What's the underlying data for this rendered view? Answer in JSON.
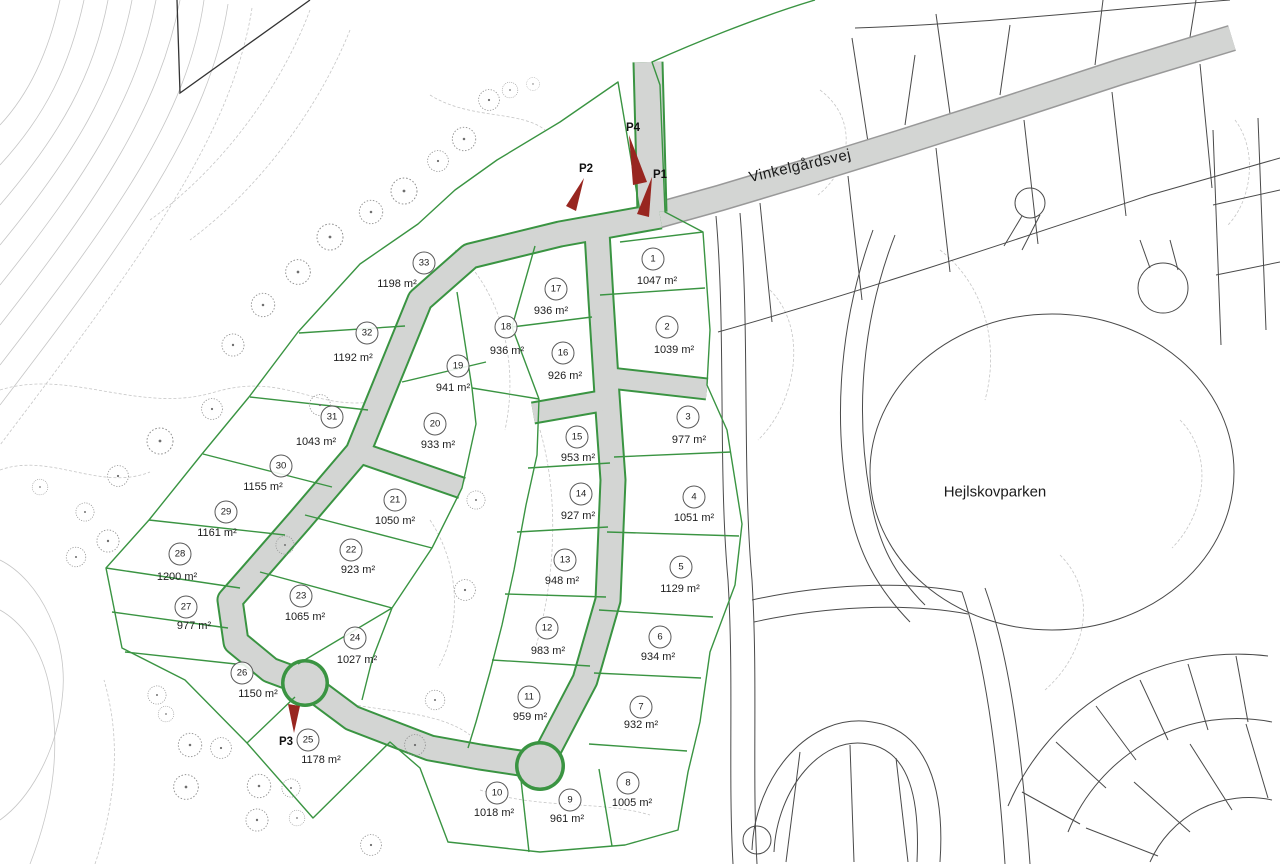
{
  "map": {
    "road_label": "Vinkelgårdsvej",
    "park_label": "Hejlskovparken"
  },
  "lots": [
    {
      "number": "1",
      "area": "1047 m²",
      "x": 653,
      "y": 259,
      "ax": 657,
      "ay": 281
    },
    {
      "number": "2",
      "area": "1039 m²",
      "x": 667,
      "y": 327,
      "ax": 674,
      "ay": 350
    },
    {
      "number": "3",
      "area": "977 m²",
      "x": 688,
      "y": 417,
      "ax": 689,
      "ay": 440
    },
    {
      "number": "4",
      "area": "1051 m²",
      "x": 694,
      "y": 497,
      "ax": 694,
      "ay": 518
    },
    {
      "number": "5",
      "area": "1129 m²",
      "x": 681,
      "y": 567,
      "ax": 680,
      "ay": 589
    },
    {
      "number": "6",
      "area": "934 m²",
      "x": 660,
      "y": 637,
      "ax": 658,
      "ay": 657
    },
    {
      "number": "7",
      "area": "932 m²",
      "x": 641,
      "y": 707,
      "ax": 641,
      "ay": 725
    },
    {
      "number": "8",
      "area": "1005 m²",
      "x": 628,
      "y": 783,
      "ax": 632,
      "ay": 803
    },
    {
      "number": "9",
      "area": "961 m²",
      "x": 570,
      "y": 800,
      "ax": 567,
      "ay": 819
    },
    {
      "number": "10",
      "area": "1018 m²",
      "x": 497,
      "y": 793,
      "ax": 494,
      "ay": 813
    },
    {
      "number": "11",
      "area": "959 m²",
      "x": 529,
      "y": 697,
      "ax": 530,
      "ay": 717
    },
    {
      "number": "12",
      "area": "983 m²",
      "x": 547,
      "y": 628,
      "ax": 548,
      "ay": 651
    },
    {
      "number": "13",
      "area": "948 m²",
      "x": 565,
      "y": 560,
      "ax": 562,
      "ay": 581
    },
    {
      "number": "14",
      "area": "927 m²",
      "x": 581,
      "y": 494,
      "ax": 578,
      "ay": 516
    },
    {
      "number": "15",
      "area": "953 m²",
      "x": 577,
      "y": 437,
      "ax": 578,
      "ay": 458
    },
    {
      "number": "16",
      "area": "926 m²",
      "x": 563,
      "y": 353,
      "ax": 565,
      "ay": 376
    },
    {
      "number": "17",
      "area": "936 m²",
      "x": 556,
      "y": 289,
      "ax": 551,
      "ay": 311
    },
    {
      "number": "18",
      "area": "936 m²",
      "x": 506,
      "y": 327,
      "ax": 507,
      "ay": 351
    },
    {
      "number": "19",
      "area": "941 m²",
      "x": 458,
      "y": 366,
      "ax": 453,
      "ay": 388
    },
    {
      "number": "20",
      "area": "933 m²",
      "x": 435,
      "y": 424,
      "ax": 438,
      "ay": 445
    },
    {
      "number": "21",
      "area": "1050 m²",
      "x": 395,
      "y": 500,
      "ax": 395,
      "ay": 521
    },
    {
      "number": "22",
      "area": "923 m²",
      "x": 351,
      "y": 550,
      "ax": 358,
      "ay": 570
    },
    {
      "number": "23",
      "area": "1065 m²",
      "x": 301,
      "y": 596,
      "ax": 305,
      "ay": 617
    },
    {
      "number": "24",
      "area": "1027 m²",
      "x": 355,
      "y": 638,
      "ax": 357,
      "ay": 660
    },
    {
      "number": "25",
      "area": "1178 m²",
      "x": 308,
      "y": 740,
      "ax": 321,
      "ay": 760
    },
    {
      "number": "26",
      "area": "1150 m²",
      "x": 242,
      "y": 673,
      "ax": 258,
      "ay": 694
    },
    {
      "number": "27",
      "area": "977 m²",
      "x": 186,
      "y": 607,
      "ax": 194,
      "ay": 626
    },
    {
      "number": "28",
      "area": "1200 m²",
      "x": 180,
      "y": 554,
      "ax": 177,
      "ay": 577
    },
    {
      "number": "29",
      "area": "1161 m²",
      "x": 226,
      "y": 512,
      "ax": 217,
      "ay": 533
    },
    {
      "number": "30",
      "area": "1155 m²",
      "x": 281,
      "y": 466,
      "ax": 263,
      "ay": 487
    },
    {
      "number": "31",
      "area": "1043 m²",
      "x": 332,
      "y": 417,
      "ax": 316,
      "ay": 442
    },
    {
      "number": "32",
      "area": "1192 m²",
      "x": 367,
      "y": 333,
      "ax": 353,
      "ay": 358
    },
    {
      "number": "33",
      "area": "1198 m²",
      "x": 424,
      "y": 263,
      "ax": 397,
      "ay": 284
    }
  ],
  "flags": [
    {
      "label": "P1",
      "x": 660,
      "y": 175
    },
    {
      "label": "P2",
      "x": 586,
      "y": 169
    },
    {
      "label": "P3",
      "x": 286,
      "y": 742
    },
    {
      "label": "P4",
      "x": 633,
      "y": 128
    }
  ],
  "colors": {
    "parcel_line": "#3a9442",
    "road_fill": "#d3d5d3",
    "road_edge": "#999999",
    "existing_line": "#4a4a4a",
    "contour": "#c6c6c6",
    "flag": "#982620",
    "text": "#1d1d1d"
  }
}
